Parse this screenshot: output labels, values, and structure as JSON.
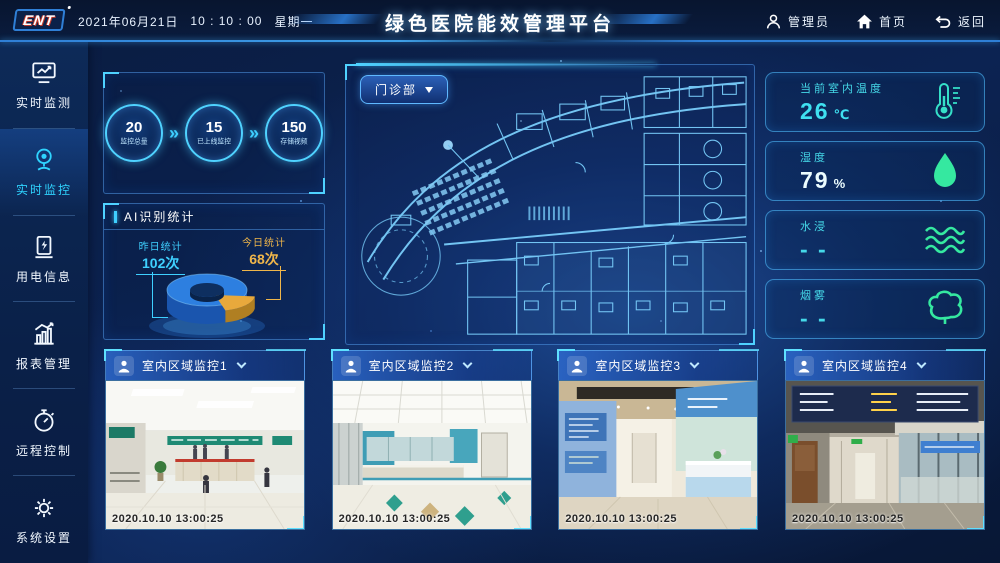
{
  "header": {
    "logo": "ENT",
    "date": "2021年06月21日",
    "time": "10 : 10 : 00",
    "weekday": "星期一",
    "title": "绿色医院能效管理平台",
    "user_label": "管理员",
    "home_label": "首页",
    "back_label": "返回"
  },
  "sidebar": {
    "items": [
      {
        "label": "实时监测",
        "icon": "monitor-chart-icon",
        "active": false
      },
      {
        "label": "实时监控",
        "icon": "webcam-icon",
        "active": true
      },
      {
        "label": "用电信息",
        "icon": "charging-pile-icon",
        "active": false
      },
      {
        "label": "报表管理",
        "icon": "bar-chart-icon",
        "active": false
      },
      {
        "label": "远程控制",
        "icon": "stopwatch-icon",
        "active": false
      },
      {
        "label": "系统设置",
        "icon": "gear-icon",
        "active": false
      }
    ]
  },
  "stats": {
    "items": [
      {
        "value": "20",
        "label": "监控总量"
      },
      {
        "value": "15",
        "label": "已上线监控"
      },
      {
        "value": "150",
        "label": "存储视频"
      }
    ]
  },
  "ai_panel": {
    "title": "AI识别统计",
    "yesterday_label": "昨日统计",
    "yesterday_value": "102次",
    "today_label": "今日统计",
    "today_value": "68次",
    "chart_data": {
      "type": "pie",
      "labels": [
        "昨日统计",
        "今日统计"
      ],
      "values": [
        102,
        68
      ],
      "unit": "次",
      "colors": [
        "#2d7fe0",
        "#e8a93c"
      ]
    }
  },
  "floorplan": {
    "selector_label": "门诊部"
  },
  "env_cards": [
    {
      "label": "当前室内温度",
      "value": "26",
      "unit": "℃",
      "icon": "thermometer-icon"
    },
    {
      "label": "湿度",
      "value": "79",
      "unit": "%",
      "icon": "water-drop-icon"
    },
    {
      "label": "水浸",
      "value": "- -",
      "unit": "",
      "icon": "waves-icon"
    },
    {
      "label": "烟雾",
      "value": "- -",
      "unit": "",
      "icon": "smoke-icon"
    }
  ],
  "cameras": [
    {
      "title": "室内区域监控1",
      "timestamp": "2020.10.10 13:00:25"
    },
    {
      "title": "室内区域监控2",
      "timestamp": "2020.10.10 13:00:25"
    },
    {
      "title": "室内区域监控3",
      "timestamp": "2020.10.10 13:00:25"
    },
    {
      "title": "室内区域监控4",
      "timestamp": "2020.10.10 13:00:25"
    }
  ],
  "colors": {
    "accent_cyan": "#3fd6ff",
    "mint_green": "#35e8a8",
    "orange": "#eeb04a",
    "panel_border": "#3e8fd8",
    "background": "#0a1d42"
  }
}
